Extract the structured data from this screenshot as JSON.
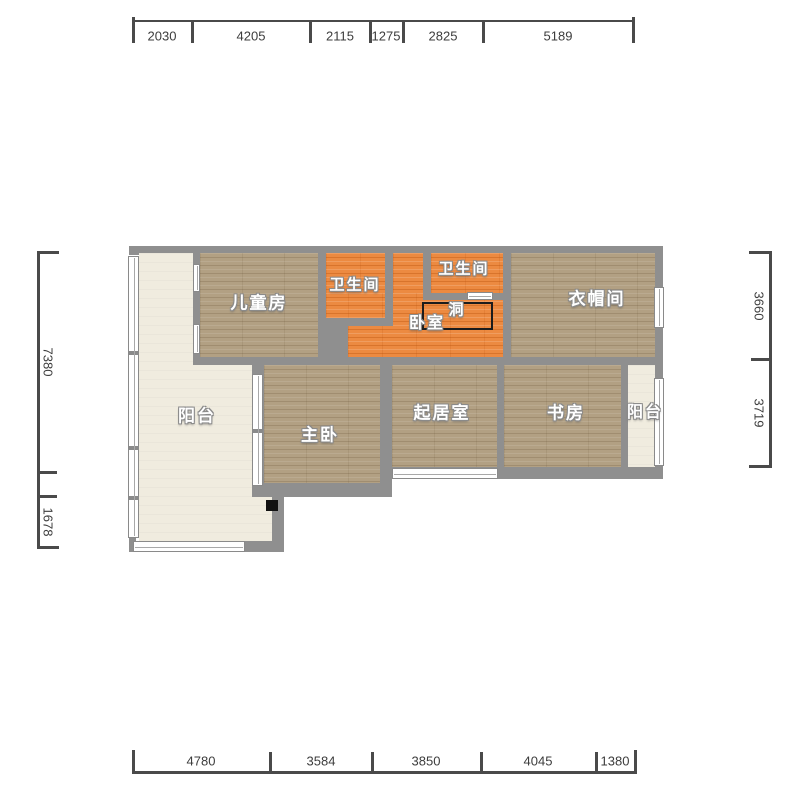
{
  "rooms": {
    "children": "儿童房",
    "bathroom_left": "卫生间",
    "bathroom_right": "卫生间",
    "cloakroom": "衣帽间",
    "bedroom": "卧室",
    "hole": "洞",
    "balcony_left": "阳台",
    "master": "主卧",
    "living": "起居室",
    "study": "书房",
    "balcony_right": "阳台"
  },
  "dimensions": {
    "top": [
      "2030",
      "4205",
      "2115",
      "1275",
      "2825",
      "5189"
    ],
    "bottom": [
      "4780",
      "3584",
      "3850",
      "4045",
      "1380"
    ],
    "left": [
      "7380",
      "1678"
    ],
    "right": [
      "3660",
      "3719"
    ]
  },
  "colors": {
    "wall": "#8f8f8f",
    "wood_floor": "#b2a083",
    "tile_floor": "#ec8a41",
    "balcony_floor": "#f0ecdf",
    "hole_outline": "#1c1c1c",
    "dimension_text": "#3c3c3c"
  }
}
